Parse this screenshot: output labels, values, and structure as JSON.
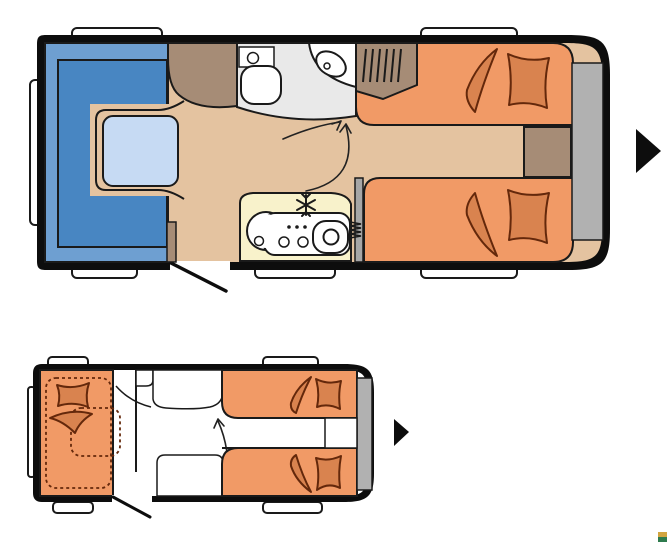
{
  "page": {
    "background": "#FFFFFF",
    "title_text": ""
  },
  "colors": {
    "pageBg": "#FFFFFF",
    "bodyBlack": "#0D0D0D",
    "lineDark": "#1A1A1A",
    "floorTan": "#E4C3A0",
    "seatOuter": "#6E9FD1",
    "seatInner": "#4886C2",
    "tableBlue": "#C6DAF3",
    "bedOrange": "#F19A66",
    "beddingFill": "#D9834F",
    "beddingStroke": "#64280B",
    "woodBrown": "#A68C76",
    "kitchenCream": "#F8F2CB",
    "bathGray": "#E9E9E9",
    "panelGray": "#B1B1B1",
    "heaterGray": "#A6A6A6",
    "white": "#FFFFFF",
    "arrowBlack": "#0D0D0D",
    "logoGold": "#D2A540",
    "logoGreen": "#2E7B4D"
  },
  "plans": [
    {
      "name": "day-layout",
      "features": [
        "u-shaped-lounge",
        "lounge-table",
        "front-wardrobe",
        "toilet",
        "corner-washbasin",
        "kitchen-block-with-sink-hob-fridge",
        "heater",
        "rear-twin-single-beds",
        "bedside-cabinet",
        "rear-wardrobe-with-rail",
        "rear-panel",
        "entry-door",
        "windows",
        "walkway-arrows",
        "direction-arrow"
      ]
    },
    {
      "name": "night-layout",
      "features": [
        "front-lounge-converted-bed",
        "washroom-outline",
        "rear-twin-single-beds",
        "bedside-cabinet",
        "rear-panel",
        "entry-door",
        "windows",
        "walkway-arrow",
        "direction-arrow"
      ]
    }
  ],
  "icons": {
    "direction_arrow": "right-triangle",
    "fridge": "snowflake",
    "heater": "coil"
  },
  "logo": {
    "top_color": "#D2A540",
    "bottom_color": "#2E7B4D"
  }
}
